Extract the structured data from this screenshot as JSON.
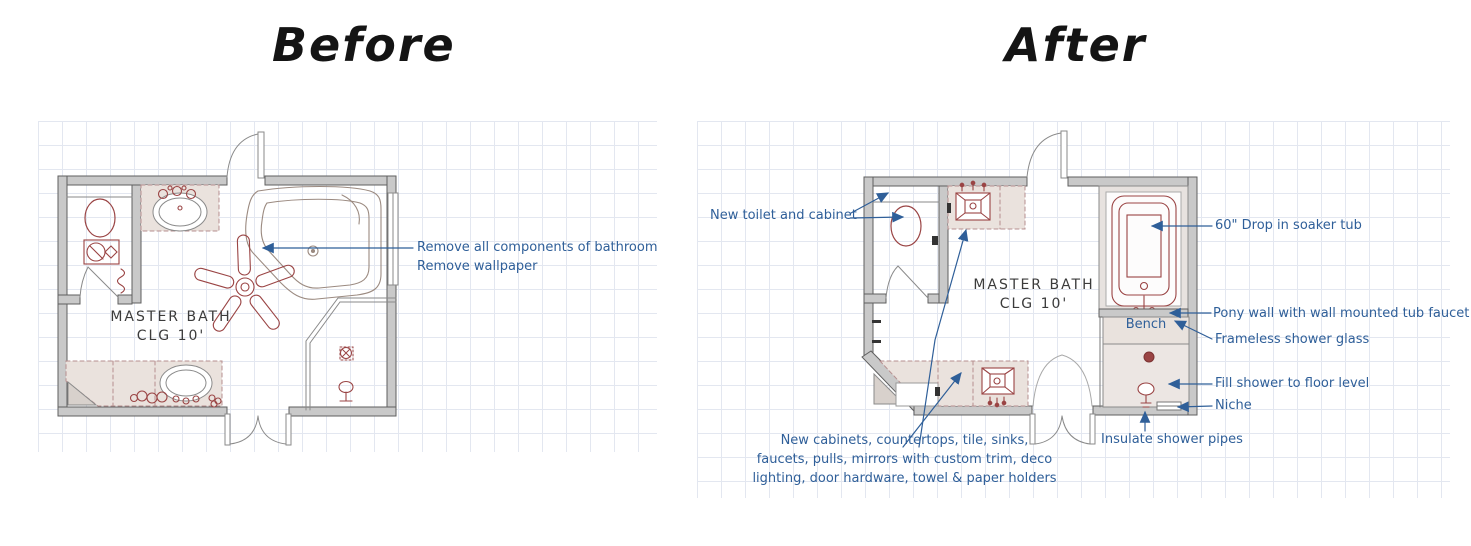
{
  "titles": {
    "before": "Before",
    "after": "After"
  },
  "before": {
    "room_name": "MASTER BATH",
    "ceiling": "CLG 10'",
    "notes": {
      "remove_components": "Remove all components of bathroom",
      "remove_wallpaper": "Remove wallpaper"
    }
  },
  "after": {
    "room_name": "MASTER BATH",
    "ceiling": "CLG 10'",
    "bench": "Bench",
    "notes": {
      "new_toilet": "New toilet and cabinet",
      "soaker_tub": "60\" Drop in soaker tub",
      "pony_wall": "Pony wall with wall mounted tub faucet",
      "frameless_glass": "Frameless shower glass",
      "fill_shower": "Fill shower to floor level",
      "niche": "Niche",
      "insulate_pipes": "Insulate shower pipes",
      "new_cabinets_1": "New cabinets, countertops, tile, sinks,",
      "new_cabinets_2": "faucets, pulls, mirrors with custom trim, deco",
      "new_cabinets_3": "lighting, door hardware, towel & paper holders"
    }
  },
  "colors": {
    "annotation_blue": "#2f5f99",
    "fixture_maroon": "#9a4444",
    "wall_gray": "#c9c9c9",
    "counter_fill": "#eae2dd",
    "grid_line": "#e3e7f0"
  }
}
